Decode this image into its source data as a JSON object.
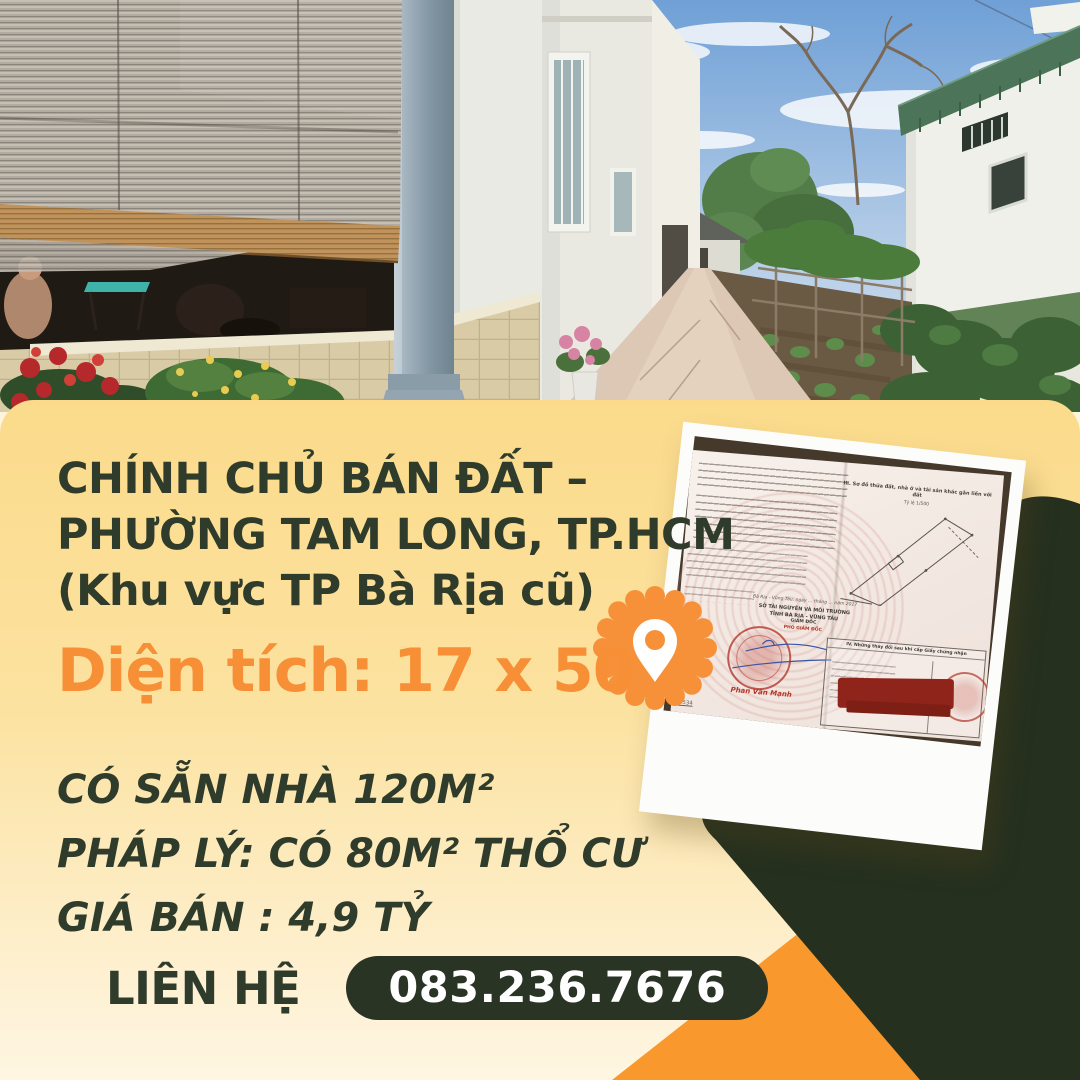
{
  "poster": {
    "headline": [
      "CHÍNH CHỦ BÁN ĐẤT –",
      "PHƯỜNG TAM LONG, TP.HCM",
      "(Khu vực TP Bà Rịa cũ)"
    ],
    "area_line": "Diện tích: 17 x 50",
    "details": [
      "CÓ SẴN NHÀ 120M²",
      "PHÁP LÝ: CÓ 80M² THỔ CƯ",
      "GIÁ BÁN : 4,9 TỶ"
    ],
    "contact_label": "LIÊN HỆ",
    "phone": "083.236.7676"
  },
  "certificate": {
    "section_iii_heading": "III. Sơ đồ thửa đất, nhà ở và tài sản khác gắn liền với đất",
    "scale_note": "Tỷ lệ 1/500",
    "place_date_line": "Bà Rịa - Vũng Tàu, ngày … tháng … năm 2017",
    "agency_line1": "SỞ TÀI NGUYÊN VÀ MÔI TRƯỜNG",
    "agency_line2": "TỈNH BÀ RỊA - VŨNG TÀU",
    "agency_line3": "GIÁM ĐỐC",
    "signer_title": "PHÓ GIÁM ĐỐC",
    "signer_name": "Phan Văn Mạnh",
    "section_iv_heading": "IV. Những thay đổi sau khi cấp Giấy chứng nhận",
    "serial_note": "05534"
  },
  "icons": {
    "location_pin": "location-pin-icon"
  },
  "colors": {
    "panel_top": "#FBDB8B",
    "panel_bottom": "#FEF3DA",
    "dark_green": "#25301E",
    "pill_green": "#2A3424",
    "orange_badge": "#F6913A",
    "orange_triangle": "#F9992D",
    "headline_green": "#2F3B2B",
    "area_orange": "#F68F35"
  }
}
